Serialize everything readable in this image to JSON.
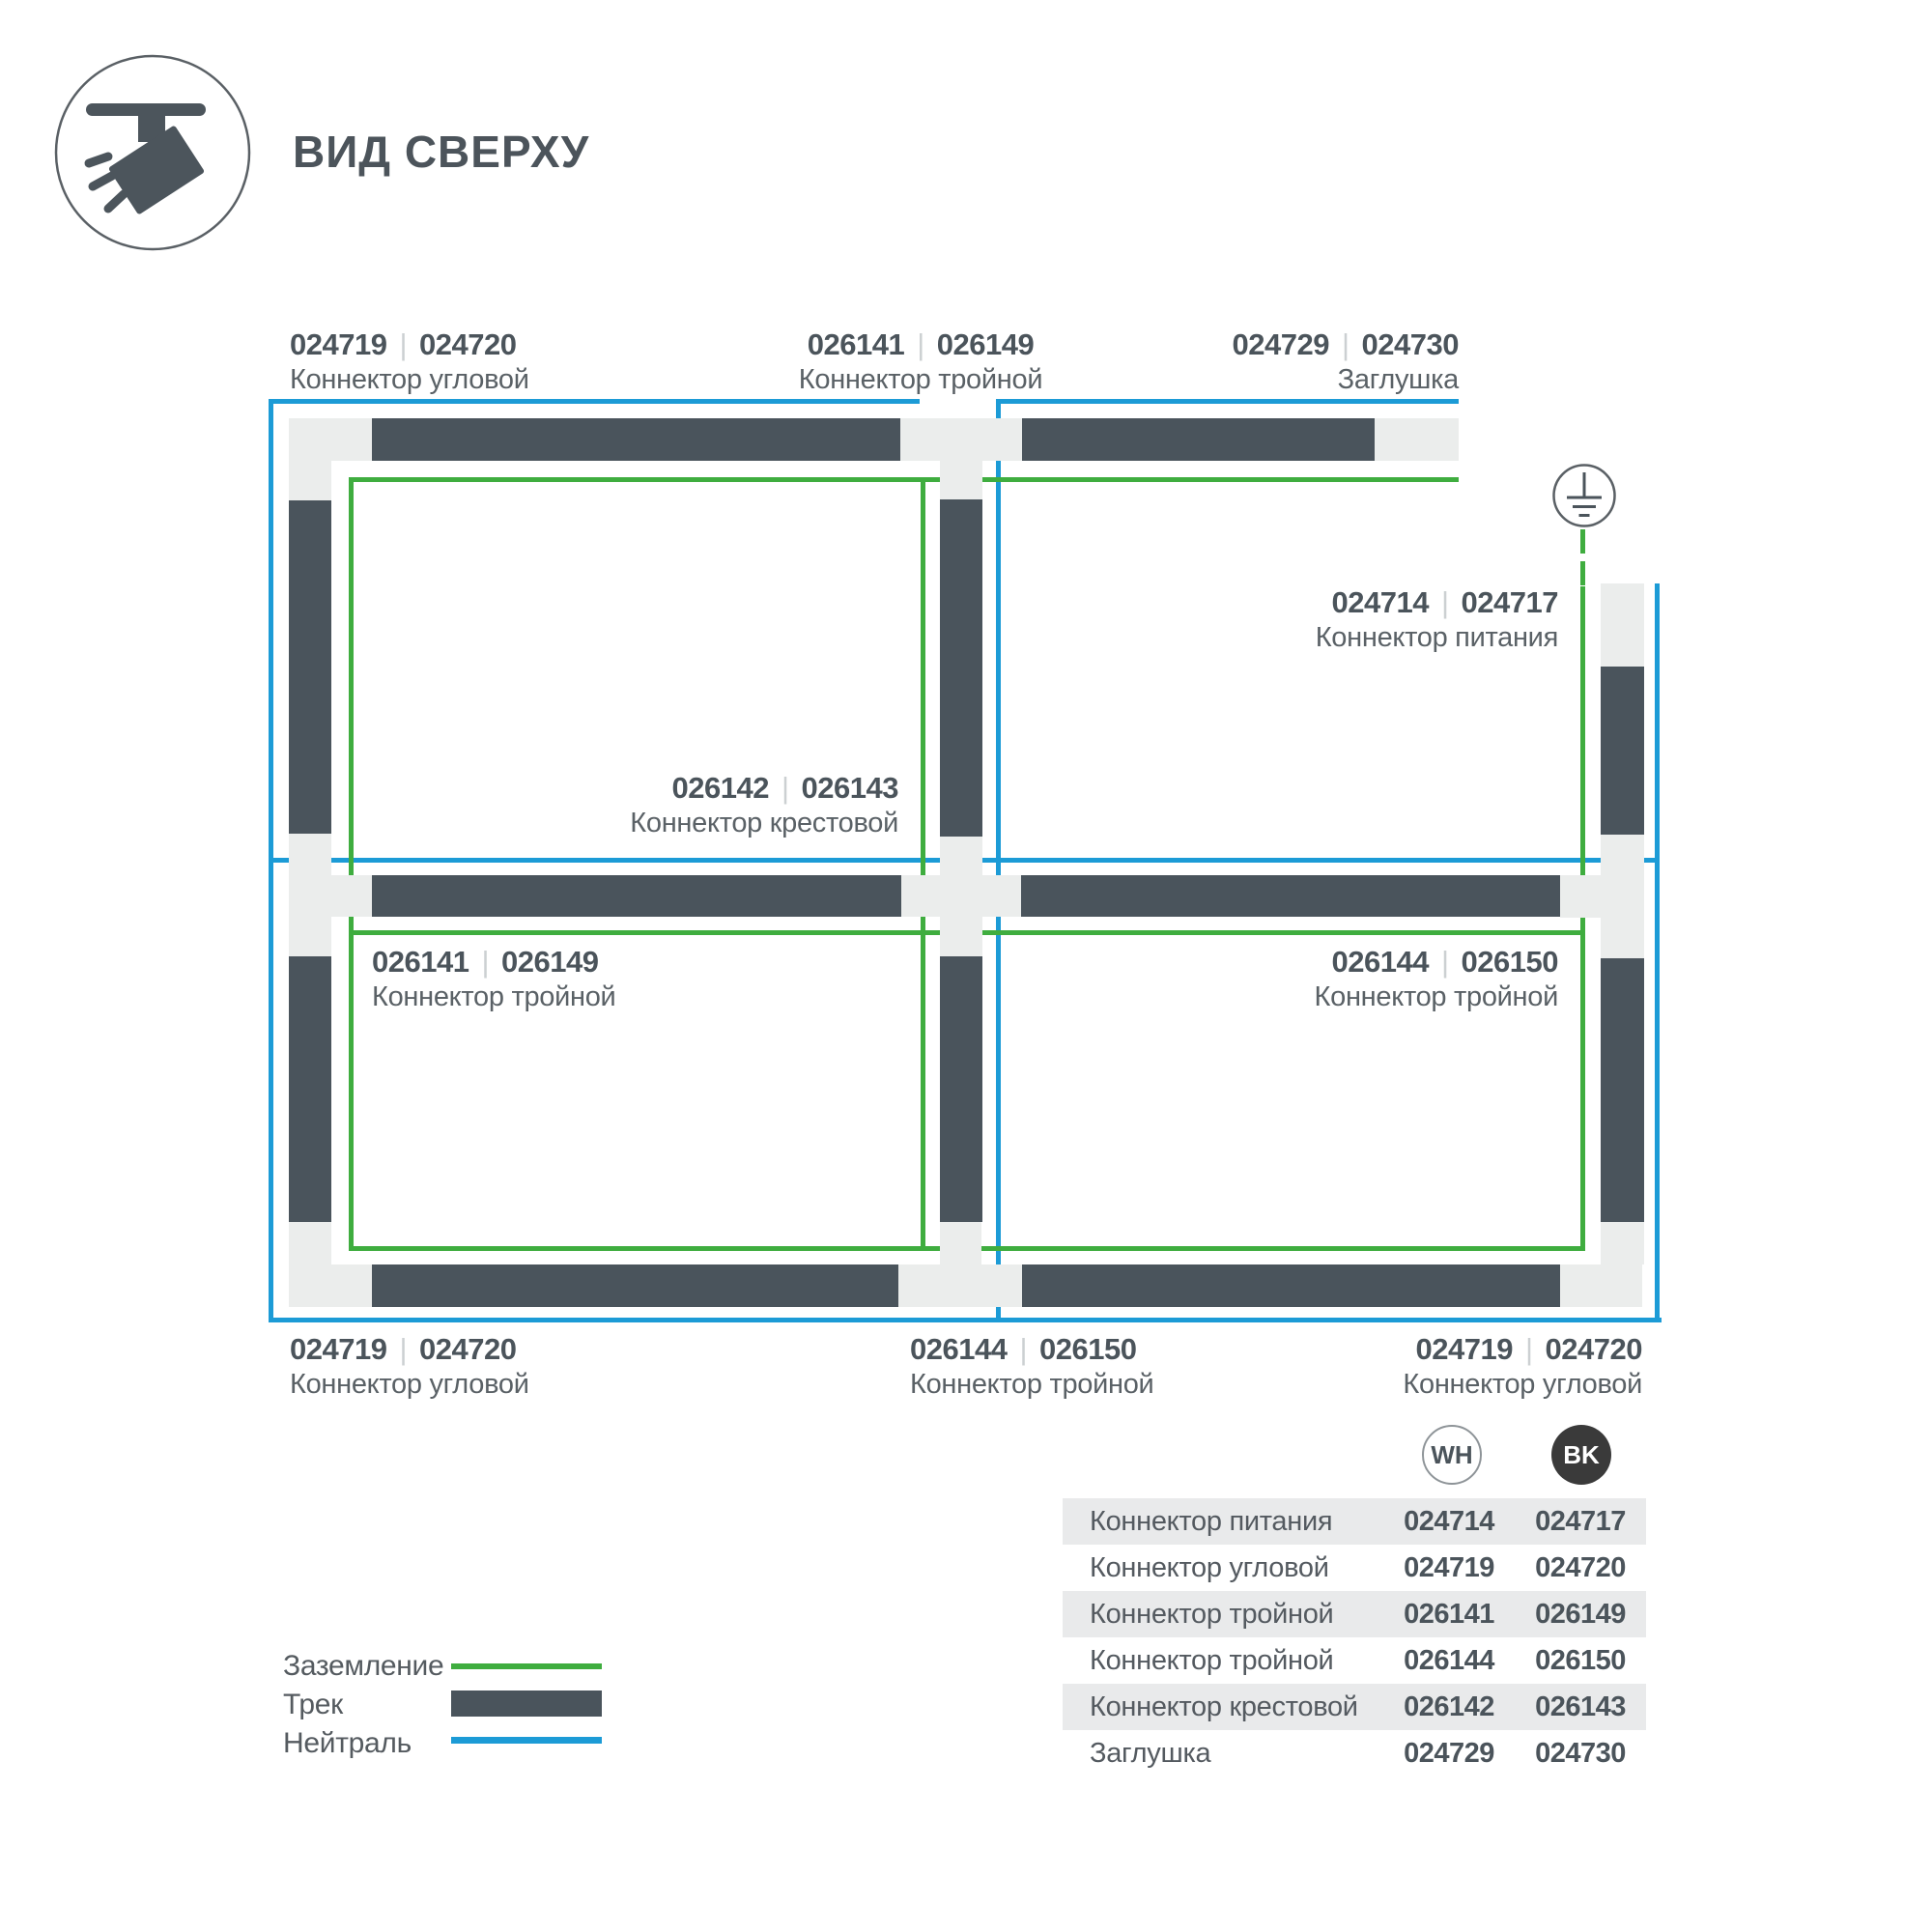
{
  "header": {
    "title": "ВИД СВЕРХУ",
    "icon": "track-light-top-view-icon"
  },
  "diagram": {
    "ground_symbol": "earth-ground-icon",
    "labels": [
      {
        "id": "top-left",
        "code_wh": "024719",
        "code_bk": "024720",
        "name": "Коннектор угловой"
      },
      {
        "id": "top-middle",
        "code_wh": "026141",
        "code_bk": "026149",
        "name": "Коннектор тройной"
      },
      {
        "id": "top-right",
        "code_wh": "024729",
        "code_bk": "024730",
        "name": "Заглушка"
      },
      {
        "id": "power",
        "code_wh": "024714",
        "code_bk": "024717",
        "name": "Коннектор питания"
      },
      {
        "id": "cross",
        "code_wh": "026142",
        "code_bk": "026143",
        "name": "Коннектор крестовой"
      },
      {
        "id": "mid-left",
        "code_wh": "026141",
        "code_bk": "026149",
        "name": "Коннектор тройной"
      },
      {
        "id": "mid-right",
        "code_wh": "026144",
        "code_bk": "026150",
        "name": "Коннектор тройной"
      },
      {
        "id": "bottom-left",
        "code_wh": "024719",
        "code_bk": "024720",
        "name": "Коннектор угловой"
      },
      {
        "id": "bottom-middle",
        "code_wh": "026144",
        "code_bk": "026150",
        "name": "Коннектор тройной"
      },
      {
        "id": "bottom-right",
        "code_wh": "024719",
        "code_bk": "024720",
        "name": "Коннектор угловой"
      }
    ]
  },
  "legend": {
    "items": [
      {
        "label": "Заземление",
        "swatch": "green-line",
        "color": "#3fad3f"
      },
      {
        "label": "Трек",
        "swatch": "dark-bar",
        "color": "#4a545c"
      },
      {
        "label": "Нейтраль",
        "swatch": "blue-line",
        "color": "#1c9bd6"
      }
    ]
  },
  "variants": {
    "wh": "WH",
    "bk": "BK"
  },
  "table": {
    "rows": [
      {
        "name": "Коннектор питания",
        "wh": "024714",
        "bk": "024717"
      },
      {
        "name": "Коннектор угловой",
        "wh": "024719",
        "bk": "024720"
      },
      {
        "name": "Коннектор тройной",
        "wh": "026141",
        "bk": "026149"
      },
      {
        "name": "Коннектор тройной",
        "wh": "026144",
        "bk": "026150"
      },
      {
        "name": "Коннектор крестовой",
        "wh": "026142",
        "bk": "026143"
      },
      {
        "name": "Заглушка",
        "wh": "024729",
        "bk": "024730"
      }
    ]
  },
  "colors": {
    "track": "#4a545c",
    "connector": "#ebedec",
    "ground_green": "#3fad3f",
    "neutral_blue": "#1c9bd6",
    "text_primary": "#4b545b",
    "text_secondary": "#5a6166",
    "bk_badge": "#3a3a3a"
  }
}
